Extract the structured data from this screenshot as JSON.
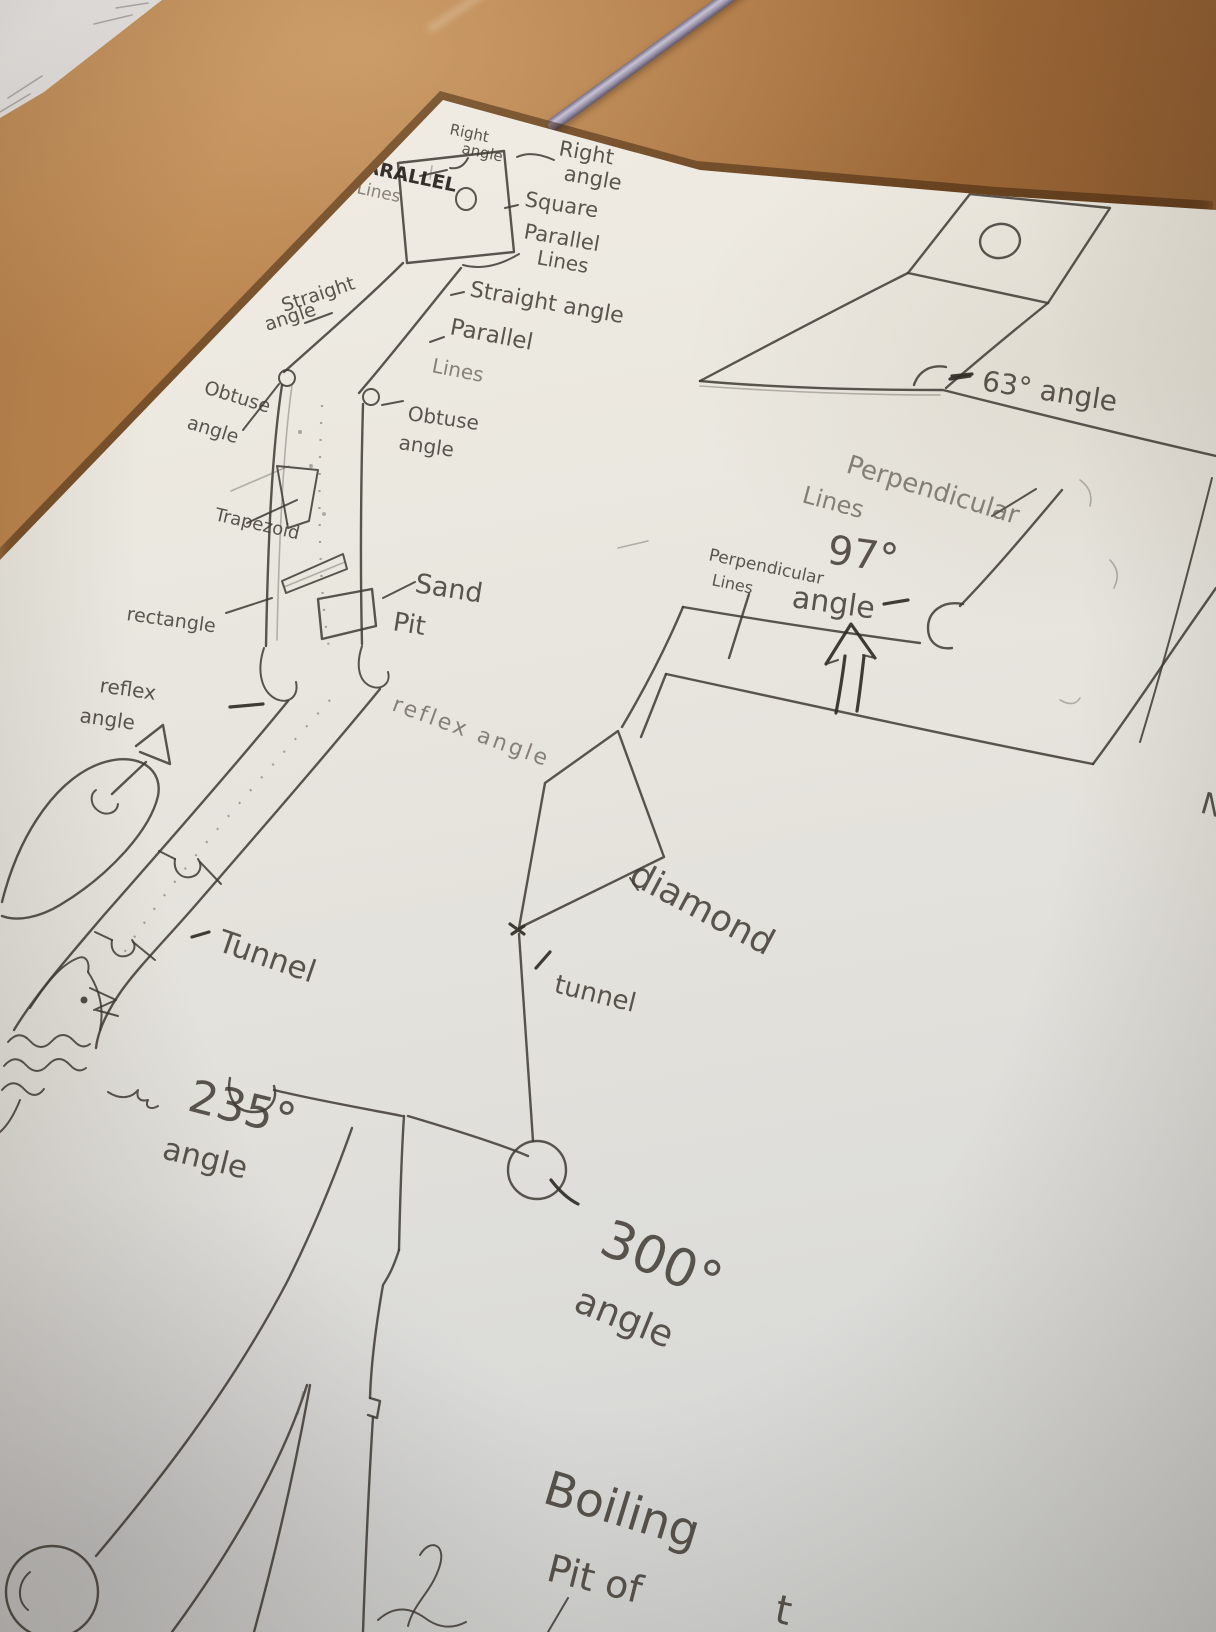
{
  "colors": {
    "desk": "#a9713e",
    "paper": "#e9e6de",
    "pencil": "#4a453f",
    "pen_barrel": "#9d96ad"
  },
  "labels": {
    "right_angle_left": [
      "Right",
      "angle"
    ],
    "right_angle_right": [
      "Right",
      "angle"
    ],
    "square": "Square",
    "parallel_lines_upper": [
      "Parallel",
      "Lines"
    ],
    "parallel_lines_edge": [
      "PARALLEL",
      "Lines"
    ],
    "straight_angle_left": [
      "Straight",
      "angle"
    ],
    "straight_angle_right": "Straight angle",
    "parallel_mid": [
      "Parallel",
      "Lines"
    ],
    "obtuse_angle_left": [
      "Obtuse",
      "angle"
    ],
    "obtuse_angle_right": [
      "Obtuse",
      "angle"
    ],
    "trapezoid": "Trapezoid",
    "rectangle": "rectangle",
    "sand_pit": [
      "Sand",
      "Pit"
    ],
    "reflex_angle_left": [
      "reflex",
      "angle"
    ],
    "reflex_angle_right": "reflex angle",
    "tunnel_main": "Tunnel",
    "tunnel_small": "tunnel",
    "diamond": "diamond",
    "angle_235": [
      "235°",
      "angle"
    ],
    "angle_300": [
      "300°",
      "angle"
    ],
    "angle_97": [
      "97°",
      "angle"
    ],
    "angle_63": "63° angle",
    "perpendicular_big": [
      "Perpendicular",
      "Lines"
    ],
    "perpendicular_small": [
      "Perpendicular",
      "Lines"
    ],
    "boiling_pit": [
      "Boiling",
      "Pit of",
      "t"
    ],
    "edge_letter": "N"
  }
}
